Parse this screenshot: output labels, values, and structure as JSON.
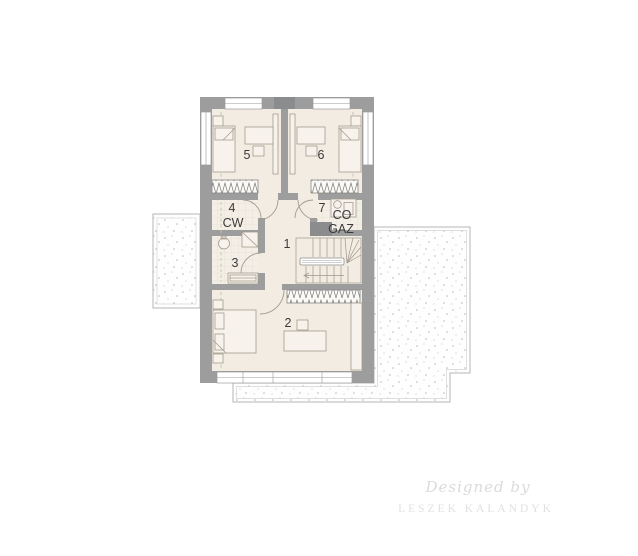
{
  "plan": {
    "type": "floor-plan",
    "rooms": {
      "r1": {
        "num": "1",
        "kind": "hall-landing"
      },
      "r2": {
        "num": "2",
        "kind": "bedroom"
      },
      "r3": {
        "num": "3",
        "kind": "bathroom"
      },
      "r4": {
        "num": "4",
        "kind": "closet"
      },
      "r5": {
        "num": "5",
        "kind": "bedroom"
      },
      "r6": {
        "num": "6",
        "kind": "bedroom"
      },
      "r7": {
        "num": "7",
        "kind": "boiler-room"
      }
    },
    "annotations": {
      "cw": "CW",
      "co": "CO",
      "gaz": "GAZ"
    }
  },
  "watermark": {
    "prefix": "Designed by",
    "name": "LESZEK KALANDYK"
  },
  "colors": {
    "wall": "#9d9d9d",
    "dark_wall": "#8b8c8e",
    "floor": "#f2ece2",
    "floor_tile": "#f4efe6",
    "furn_fill": "#f7f3ec",
    "outline": "#a39a8d",
    "terrace_border": "#b5b5b5",
    "dots": "#b9b9b9",
    "window": "#ffffff",
    "text": "#3a3a3a",
    "watermark": "#dcdadb",
    "watermark2": "#e3e0e0"
  }
}
